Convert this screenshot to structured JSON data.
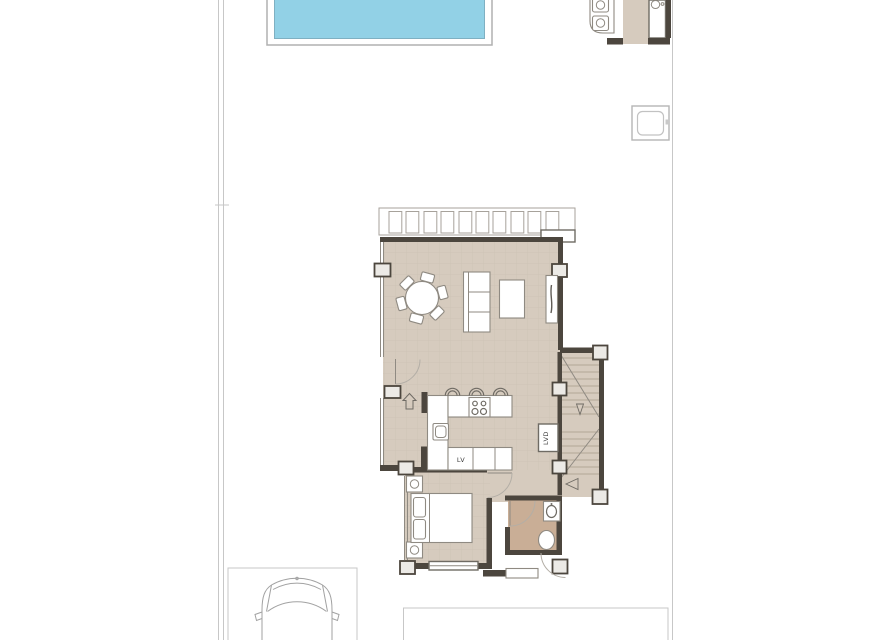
{
  "plan": {
    "type": "residential-floor-plan",
    "labels": {
      "dishwasher": "LV",
      "washing_machine": "LVD"
    },
    "colors": {
      "floor": "#d6cbbe",
      "bath": "#c9ae96",
      "pool": "#92d1e6",
      "wall": "#4c463e",
      "thin": "#8f8a82",
      "boundary": "#c7c7c7",
      "tread": "#b2a797"
    },
    "rooms": [
      "terrace-glazing",
      "living-dining",
      "kitchen",
      "hall",
      "staircase",
      "bedroom",
      "bathroom",
      "entry-porch"
    ],
    "outdoor": [
      "swimming-pool",
      "outdoor-kitchen",
      "utility-box",
      "parking-space",
      "car",
      "patio"
    ]
  }
}
